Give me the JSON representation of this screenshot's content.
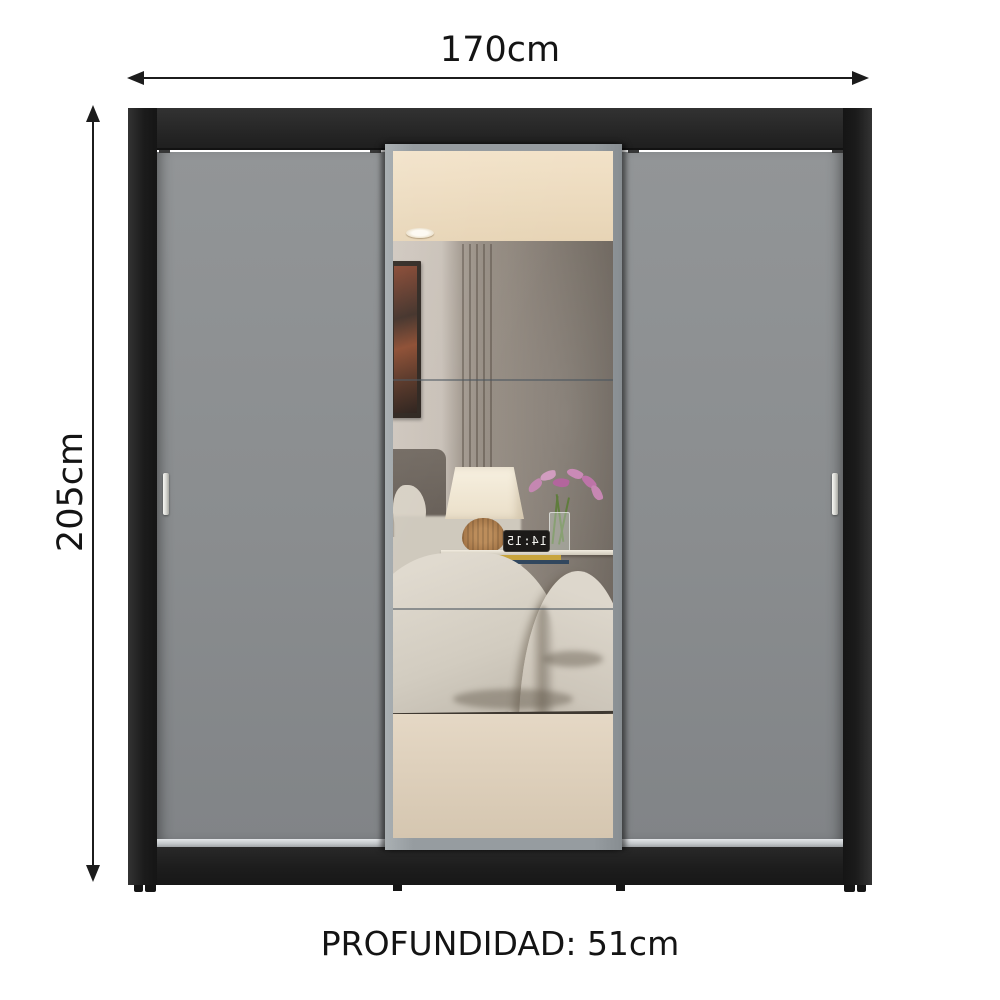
{
  "labels": {
    "width": "170cm",
    "height": "205cm",
    "depth": "PROFUNDIDAD: 51cm"
  },
  "mirror_scene": {
    "clock_display": "14:15"
  },
  "colors": {
    "background": "#ffffff",
    "annotation": "#1c1c1c",
    "frame_black": "#242424",
    "door_gray": "#8b8e90",
    "handle_silver": "#e9e9e4",
    "bottom_rail": "#c9cdd0",
    "mirror_frame": "#9aa0a4",
    "reflection_ceiling": "#ecd9bd",
    "reflection_wall_light": "#cbc3ba",
    "reflection_wall_dark": "#6e665e",
    "bedding": "#d6d0c5",
    "lamp_shade": "#f4edde",
    "lamp_base_wicker": "#a87a4e",
    "flowers_pink": "#c487b2",
    "bed_base": "#dccdb8"
  }
}
